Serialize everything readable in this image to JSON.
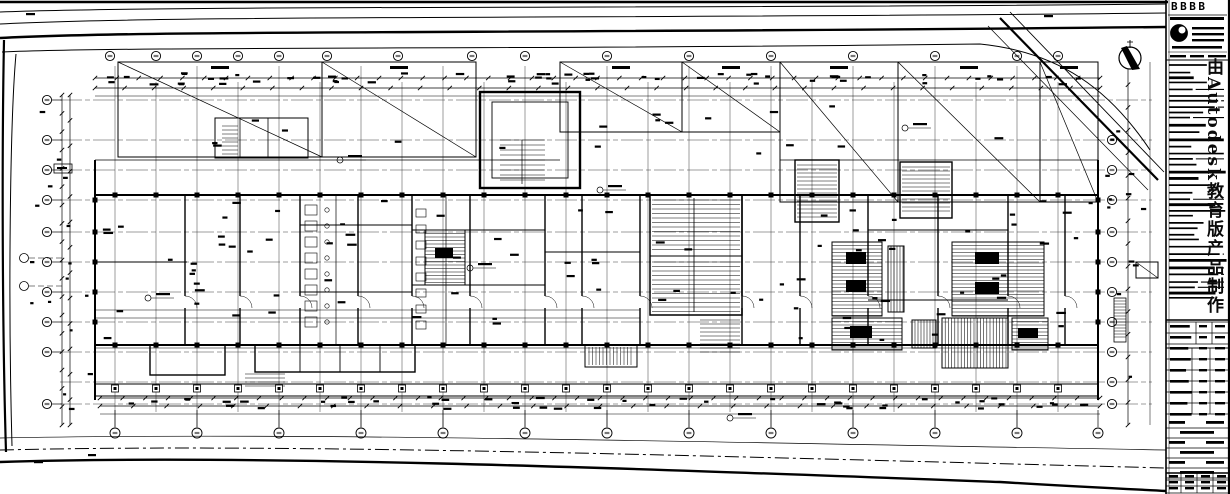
{
  "sheet": {
    "kind": "architectural floor plan (CAD blueprint)",
    "title_block": {
      "company": "BBBB",
      "watermark": "由Autodesk教育版产品制作"
    },
    "north_arrow": {
      "present": "yes"
    },
    "colors": {
      "ink": "#000000",
      "paper": "#ffffff",
      "grid": "#3a3a3a"
    }
  }
}
